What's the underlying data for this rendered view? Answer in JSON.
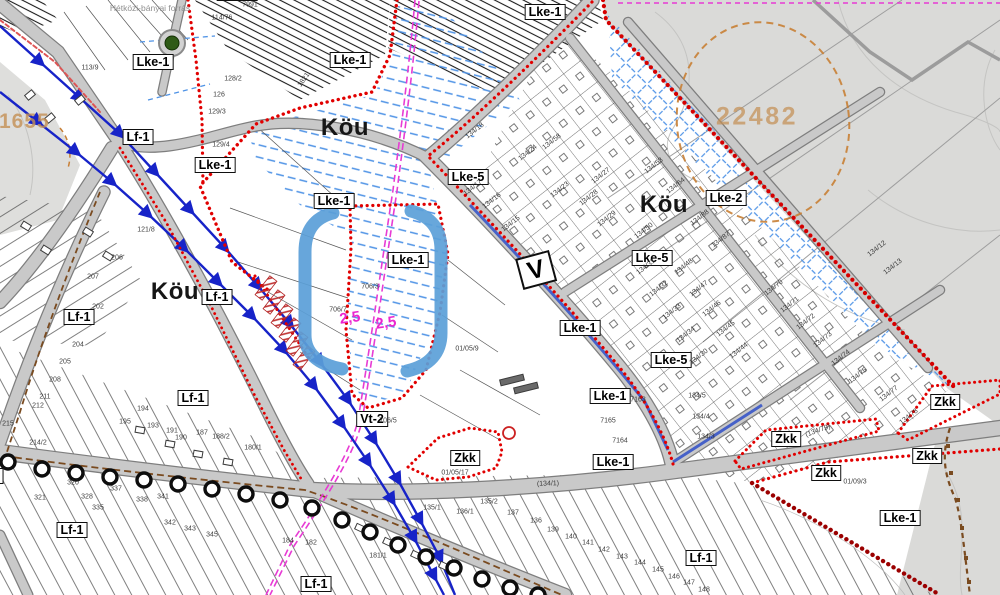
{
  "map": {
    "zone_labels": [
      {
        "t": "Lke-1",
        "x": 153,
        "y": 62
      },
      {
        "t": "Lf-1",
        "x": 138,
        "y": 137
      },
      {
        "t": "Lke-1",
        "x": 215,
        "y": 165
      },
      {
        "t": "Lke-1",
        "x": 237,
        "y": -7
      },
      {
        "t": "Lke-1",
        "x": 350,
        "y": 60
      },
      {
        "t": "Lke-1",
        "x": 545,
        "y": 12
      },
      {
        "t": "Lke-5",
        "x": 468,
        "y": 177
      },
      {
        "t": "Lke-1",
        "x": 334,
        "y": 201
      },
      {
        "t": "Lke-1",
        "x": 408,
        "y": 260
      },
      {
        "t": "Lke-2",
        "x": 726,
        "y": 198
      },
      {
        "t": "Lke-5",
        "x": 652,
        "y": 258
      },
      {
        "t": "Lke-1",
        "x": 580,
        "y": 328
      },
      {
        "t": "Lke-5",
        "x": 671,
        "y": 360
      },
      {
        "t": "Lf-1",
        "x": 217,
        "y": 297
      },
      {
        "t": "Lf-1",
        "x": 79,
        "y": 317
      },
      {
        "t": "Lf-1",
        "x": 193,
        "y": 398
      },
      {
        "t": "Vt-2",
        "x": 372,
        "y": 419
      },
      {
        "t": "Zkk",
        "x": 465,
        "y": 458
      },
      {
        "t": "Lke-1",
        "x": 610,
        "y": 396
      },
      {
        "t": "Lke-1",
        "x": 613,
        "y": 462
      },
      {
        "t": "Lf-1",
        "x": 72,
        "y": 530
      },
      {
        "t": "Lf-1",
        "x": 316,
        "y": 584
      },
      {
        "t": "Lf-1",
        "x": 701,
        "y": 558
      },
      {
        "t": "Lke-1",
        "x": 900,
        "y": 518
      },
      {
        "t": "Zkk",
        "x": 786,
        "y": 439
      },
      {
        "t": "Zkk",
        "x": 945,
        "y": 402
      },
      {
        "t": "Zkk",
        "x": 927,
        "y": 456
      },
      {
        "t": "Zkk",
        "x": 826,
        "y": 473
      },
      {
        "t": "Lf-1",
        "x": -12,
        "y": 476
      }
    ],
    "road_labels": [
      {
        "t": "Köu",
        "x": 345,
        "y": 128
      },
      {
        "t": "Köu",
        "x": 664,
        "y": 205
      },
      {
        "t": "Köu",
        "x": 175,
        "y": 292
      }
    ],
    "v_marker": {
      "t": "V",
      "x": 536,
      "y": 270,
      "rot": -15
    },
    "annotations": {
      "survey_left": {
        "text": "21655",
        "x": 18,
        "y": 122
      },
      "survey_right": {
        "text": "22482",
        "x": 757,
        "y": 117
      },
      "dimension_a": {
        "text": "2,5",
        "x": 350,
        "y": 318
      },
      "dimension_b": {
        "text": "2,5",
        "x": 386,
        "y": 323
      },
      "spring_label": {
        "text": "Hétközi-bányai forrás",
        "x": 150,
        "y": 8
      }
    },
    "parcel_numbers": [
      [
        "7991",
        250,
        5,
        0
      ],
      [
        "114/76",
        222,
        18,
        0
      ],
      [
        "113/9",
        90,
        68,
        0
      ],
      [
        "128/2",
        233,
        79,
        0
      ],
      [
        "126",
        219,
        95,
        0
      ],
      [
        "129/3",
        217,
        112,
        0
      ],
      [
        "129/4",
        221,
        145,
        0
      ],
      [
        "1821",
        304,
        80,
        -55
      ],
      [
        "121/8",
        146,
        230,
        0
      ],
      [
        "134/18",
        475,
        131,
        -38
      ],
      [
        "134/24",
        528,
        153,
        -38
      ],
      [
        "134/58",
        552,
        142,
        -38
      ],
      [
        "134/23",
        560,
        190,
        -38
      ],
      [
        "134/17",
        473,
        188,
        -38
      ],
      [
        "134/16",
        492,
        201,
        -38
      ],
      [
        "134/15",
        511,
        224,
        -38
      ],
      [
        "134/53",
        654,
        166,
        -38
      ],
      [
        "134/64",
        676,
        186,
        -38
      ],
      [
        "134/88",
        700,
        218,
        -38
      ],
      [
        "134/87",
        721,
        240,
        -38
      ],
      [
        "134/27",
        601,
        176,
        -38
      ],
      [
        "134/28",
        589,
        198,
        -38
      ],
      [
        "134/29",
        607,
        219,
        -38
      ],
      [
        "134/50",
        644,
        231,
        -38
      ],
      [
        "134/31",
        646,
        267,
        -38
      ],
      [
        "134/48",
        684,
        267,
        -38
      ],
      [
        "134/32",
        659,
        289,
        -38
      ],
      [
        "134/47",
        699,
        289,
        -38
      ],
      [
        "134/33",
        672,
        312,
        -38
      ],
      [
        "134/46",
        712,
        309,
        -38
      ],
      [
        "134/34",
        686,
        335,
        -38
      ],
      [
        "134/45",
        726,
        329,
        -38
      ],
      [
        "134/30",
        699,
        357,
        -38
      ],
      [
        "134/44",
        739,
        351,
        -38
      ],
      [
        "134/70",
        774,
        288,
        -38
      ],
      [
        "134/71",
        790,
        305,
        -38
      ],
      [
        "134/72",
        806,
        322,
        -38
      ],
      [
        "134/73",
        823,
        340,
        -38
      ],
      [
        "134/74",
        841,
        358,
        -38
      ],
      [
        "134/75",
        858,
        376,
        -38
      ],
      [
        "134/12",
        877,
        249,
        -38
      ],
      [
        "134/13",
        893,
        267,
        -38
      ],
      [
        "134/77",
        889,
        394,
        -38
      ],
      [
        "134/78",
        909,
        417,
        -38
      ],
      [
        "(134/79)",
        818,
        431,
        -20
      ],
      [
        "134/5",
        697,
        396,
        0
      ],
      [
        "134/4",
        701,
        417,
        0
      ],
      [
        "134/3",
        706,
        437,
        0
      ],
      [
        "706/3",
        370,
        287,
        0
      ],
      [
        "706/7",
        338,
        310,
        0
      ],
      [
        "01/05/9",
        467,
        349,
        0
      ],
      [
        "706/5",
        388,
        421,
        0
      ],
      [
        "7165",
        608,
        421,
        0
      ],
      [
        "7163",
        638,
        400,
        0
      ],
      [
        "7164",
        620,
        441,
        0
      ],
      [
        "(134/1)",
        548,
        484,
        -2
      ],
      [
        "01/05/17",
        455,
        473,
        0
      ],
      [
        "01/09/3",
        855,
        482,
        0
      ],
      [
        "202",
        98,
        307,
        0
      ],
      [
        "204",
        78,
        345,
        0
      ],
      [
        "205",
        65,
        362,
        0
      ],
      [
        "206",
        117,
        258,
        0
      ],
      [
        "207",
        93,
        277,
        0
      ],
      [
        "208",
        55,
        380,
        0
      ],
      [
        "211",
        45,
        397,
        0
      ],
      [
        "212",
        38,
        406,
        0
      ],
      [
        "215",
        8,
        424,
        0
      ],
      [
        "214/2",
        38,
        443,
        0
      ],
      [
        "194",
        143,
        409,
        0
      ],
      [
        "195",
        125,
        422,
        0
      ],
      [
        "193",
        153,
        426,
        0
      ],
      [
        "191",
        172,
        431,
        0
      ],
      [
        "190",
        181,
        438,
        0
      ],
      [
        "187",
        202,
        433,
        0
      ],
      [
        "188/2",
        221,
        437,
        0
      ],
      [
        "180/1",
        253,
        448,
        0
      ],
      [
        "181/1",
        378,
        556,
        0
      ],
      [
        "182",
        311,
        543,
        0
      ],
      [
        "184",
        288,
        541,
        0
      ],
      [
        "320",
        73,
        483,
        0
      ],
      [
        "321",
        40,
        498,
        0
      ],
      [
        "328",
        87,
        497,
        0
      ],
      [
        "335",
        98,
        508,
        0
      ],
      [
        "337",
        116,
        489,
        0
      ],
      [
        "338",
        142,
        500,
        0
      ],
      [
        "341",
        163,
        497,
        0
      ],
      [
        "342",
        170,
        523,
        0
      ],
      [
        "343",
        190,
        529,
        0
      ],
      [
        "345",
        212,
        535,
        0
      ],
      [
        "135/1",
        432,
        508,
        0
      ],
      [
        "135/2",
        489,
        502,
        0
      ],
      [
        "136/1",
        465,
        512,
        0
      ],
      [
        "137",
        513,
        513,
        0
      ],
      [
        "136",
        536,
        521,
        0
      ],
      [
        "139",
        553,
        530,
        0
      ],
      [
        "140",
        571,
        537,
        0
      ],
      [
        "141",
        588,
        543,
        0
      ],
      [
        "142",
        604,
        550,
        0
      ],
      [
        "143",
        622,
        557,
        0
      ],
      [
        "144",
        640,
        563,
        0
      ],
      [
        "145",
        658,
        570,
        0
      ],
      [
        "146",
        674,
        577,
        0
      ],
      [
        "147",
        689,
        583,
        0
      ],
      [
        "148",
        704,
        590,
        0
      ]
    ],
    "colors": {
      "boundary_red": "#e10000",
      "boundary_dark_red": "#9b0000",
      "utility_magenta": "#e73bd4",
      "hatch_blue": "#4f93e6",
      "arrow_blue": "#1723c8",
      "highlight_blue": "#5b9fd8",
      "road_fill": "#c9c9c9",
      "road_edge": "#7d7d7d",
      "terrain_gray": "#dadad8",
      "survey_orange": "#c49055",
      "chain_black": "#111111",
      "utility_brown": "#7a4b20",
      "spring_green": "#2f5b17"
    }
  }
}
